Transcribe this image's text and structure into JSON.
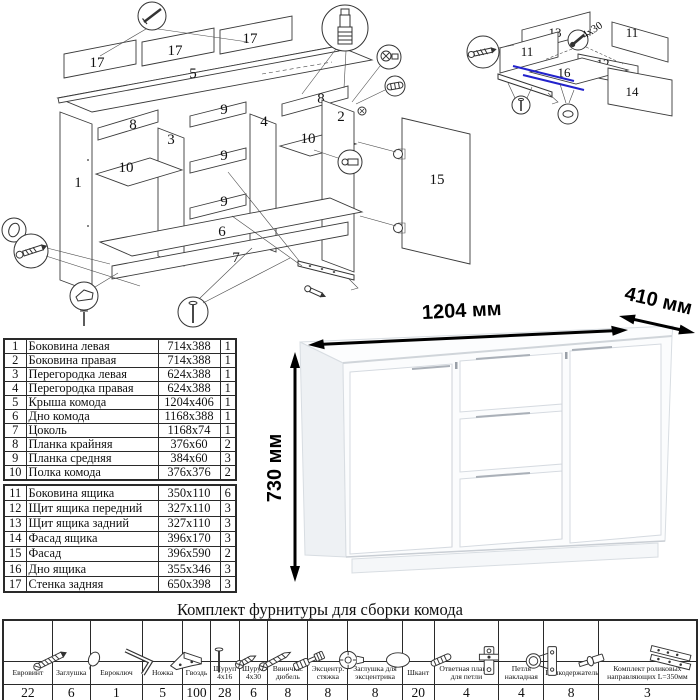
{
  "colors": {
    "line": "#3a3a3a",
    "slide_highlight_blue": "#2222cc"
  },
  "exploded": {
    "labels": {
      "p17a": "17",
      "p17b": "17",
      "p17c": "17",
      "p5": "5",
      "p8a": "8",
      "p8b": "8",
      "p9a": "9",
      "p9b": "9",
      "p9c": "9",
      "p3": "3",
      "p4": "4",
      "p1": "1",
      "p2": "2",
      "p10a": "10",
      "p10b": "10",
      "p6": "6",
      "p7": "7",
      "p15": "15"
    },
    "callouts": [
      "nail-icon",
      "screw-in-dowel-icon",
      "eccentric-cam-icon",
      "dowel-icon",
      "shelf-support-icon",
      "cap-icon",
      "confirmat-screw-icon",
      "foot-icon",
      "nail-icon",
      "roller-slide-icon",
      "screw-icon",
      "hinge-icon"
    ]
  },
  "drawer_assembly": {
    "labels": {
      "p13": "13",
      "p11a": "11",
      "p11b": "11",
      "p12": "12",
      "p16": "16",
      "p14": "14"
    },
    "screw_note": "4x30",
    "callouts": [
      "confirmat-screw-icon",
      "screw-icon",
      "screw-icon",
      "cap-icon"
    ]
  },
  "dresser": {
    "width_label": "1204 мм",
    "depth_label": "410 мм",
    "height_label": "730 мм"
  },
  "parts_table": {
    "rows": [
      {
        "num": "1",
        "name": "Боковина левая",
        "size": "714x388",
        "qty": "1"
      },
      {
        "num": "2",
        "name": "Боковина правая",
        "size": "714x388",
        "qty": "1"
      },
      {
        "num": "3",
        "name": "Перегородка левая",
        "size": "624x388",
        "qty": "1"
      },
      {
        "num": "4",
        "name": "Перегородка правая",
        "size": "624x388",
        "qty": "1"
      },
      {
        "num": "5",
        "name": "Крыша комода",
        "size": "1204x406",
        "qty": "1"
      },
      {
        "num": "6",
        "name": "Дно комода",
        "size": "1168x388",
        "qty": "1"
      },
      {
        "num": "7",
        "name": "Цоколь",
        "size": "1168x74",
        "qty": "1"
      },
      {
        "num": "8",
        "name": "Планка крайняя",
        "size": "376x60",
        "qty": "2"
      },
      {
        "num": "9",
        "name": "Планка средняя",
        "size": "384x60",
        "qty": "3"
      },
      {
        "num": "10",
        "name": "Полка комода",
        "size": "376x376",
        "qty": "2"
      },
      {
        "num": "11",
        "name": "Боковина ящика",
        "size": "350x110",
        "qty": "6"
      },
      {
        "num": "12",
        "name": "Щит ящика передний",
        "size": "327x110",
        "qty": "3"
      },
      {
        "num": "13",
        "name": "Щит ящика задний",
        "size": "327x110",
        "qty": "3"
      },
      {
        "num": "14",
        "name": "Фасад ящика",
        "size": "396x170",
        "qty": "3"
      },
      {
        "num": "15",
        "name": "Фасад",
        "size": "396x590",
        "qty": "2"
      },
      {
        "num": "16",
        "name": "Дно ящика",
        "size": "355x346",
        "qty": "3"
      },
      {
        "num": "17",
        "name": "Стенка задняя",
        "size": "650x398",
        "qty": "3"
      }
    ]
  },
  "hardware": {
    "title": "Комплект фурнитуры для сборки комода",
    "items": [
      {
        "icon": "confirmat-screw-icon",
        "name": "Евровинт",
        "qty": "22"
      },
      {
        "icon": "cap-icon",
        "name": "Заглушка",
        "qty": "6"
      },
      {
        "icon": "hex-key-icon",
        "name": "Евроключ",
        "qty": "1"
      },
      {
        "icon": "foot-icon",
        "name": "Ножка",
        "qty": "5"
      },
      {
        "icon": "nail-icon",
        "name": "Гвоздь",
        "qty": "100"
      },
      {
        "icon": "screw-small-icon",
        "name": "Шуруп 4x16",
        "qty": "28"
      },
      {
        "icon": "screw-large-icon",
        "name": "Шуруп 4x30",
        "qty": "6"
      },
      {
        "icon": "screw-in-dowel-icon",
        "name": "Ввинчив. дюбель",
        "qty": "8"
      },
      {
        "icon": "eccentric-cam-icon",
        "name": "Эксцентр. стяжка",
        "qty": "8"
      },
      {
        "icon": "cam-cap-icon",
        "name": "Заглушка для эксцентрика",
        "qty": "8"
      },
      {
        "icon": "dowel-icon",
        "name": "Шкант",
        "qty": "20"
      },
      {
        "icon": "hinge-plate-icon",
        "name": "Ответная планка для петли",
        "qty": "4"
      },
      {
        "icon": "hinge-icon",
        "name": "Петля накладная",
        "qty": "4"
      },
      {
        "icon": "shelf-support-icon",
        "name": "Полкодержатель",
        "qty": "8"
      },
      {
        "icon": "roller-slides-icon",
        "name": "Комплект роликовых направляющих L=350мм",
        "qty": "3"
      }
    ]
  }
}
